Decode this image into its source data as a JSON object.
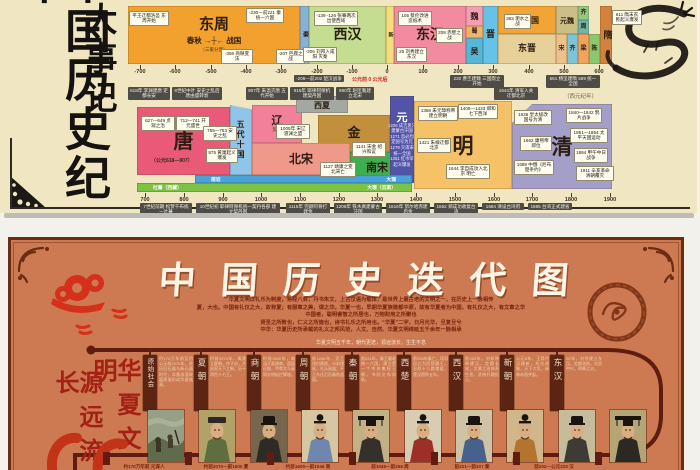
{
  "page": {
    "background": "#f2f1ec"
  },
  "top_poster": {
    "title_vertical": "中国历史纪年",
    "subtitle_vertical": "大事记",
    "era_note": "公元前 0 公元后",
    "calendar_note": "（西元纪年）",
    "row1": {
      "blocks": [
        {
          "name": "dongzhou",
          "label": "东周",
          "sub": "春秋 →┼← 战国",
          "sub2": "（三家分晋）",
          "x": 128,
          "y": 6,
          "w": 172,
          "h": 58,
          "color": "#f2a12e",
          "fs": 15
        },
        {
          "name": "qin",
          "label": "秦",
          "x": 300,
          "y": 6,
          "w": 9,
          "h": 58,
          "color": "#85b3d4",
          "fs": 6,
          "vertical": true
        },
        {
          "name": "xihan",
          "label": "西汉",
          "x": 309,
          "y": 6,
          "w": 77,
          "h": 58,
          "color": "#c4dd90",
          "fs": 14
        },
        {
          "name": "xin",
          "label": "新",
          "x": 386,
          "y": 6,
          "w": 8,
          "h": 58,
          "color": "#f2de7c",
          "fs": 5,
          "vertical": true
        },
        {
          "name": "donghan",
          "label": "东汉",
          "x": 394,
          "y": 6,
          "w": 72,
          "h": 58,
          "color": "#f28ba0",
          "fs": 14
        },
        {
          "name": "wei",
          "label": "魏",
          "x": 466,
          "y": 6,
          "w": 17,
          "h": 20,
          "color": "#f29eb4",
          "fs": 8
        },
        {
          "name": "shu",
          "label": "蜀",
          "x": 466,
          "y": 26,
          "w": 17,
          "h": 12,
          "color": "#f0b468",
          "fs": 6
        },
        {
          "name": "wu",
          "label": "吴",
          "x": 466,
          "y": 38,
          "w": 17,
          "h": 26,
          "color": "#56b6d8",
          "fs": 8
        },
        {
          "name": "jin",
          "label": "晋",
          "x": 483,
          "y": 6,
          "w": 15,
          "h": 58,
          "color": "#66c2e6",
          "fs": 9
        },
        {
          "name": "shiliuguo",
          "label": "十六国",
          "x": 498,
          "y": 6,
          "w": 58,
          "h": 28,
          "color": "#f2a434",
          "fs": 8
        },
        {
          "name": "dongjin",
          "label": "东晋",
          "x": 498,
          "y": 34,
          "w": 58,
          "h": 30,
          "color": "#e7d198",
          "fs": 9
        },
        {
          "name": "yuanwei",
          "label": "元魏",
          "x": 556,
          "y": 6,
          "w": 22,
          "h": 28,
          "color": "#ccbf86",
          "fs": 7
        },
        {
          "name": "qi-north",
          "label": "齐",
          "x": 578,
          "y": 6,
          "w": 11,
          "h": 14,
          "color": "#93c87e",
          "fs": 6
        },
        {
          "name": "zhou-north",
          "label": "周",
          "x": 578,
          "y": 20,
          "w": 11,
          "h": 14,
          "color": "#6cb9a9",
          "fs": 6
        },
        {
          "name": "song-south",
          "label": "宋",
          "x": 556,
          "y": 34,
          "w": 11,
          "h": 30,
          "color": "#ecc28a",
          "fs": 6
        },
        {
          "name": "qi-south",
          "label": "齐",
          "x": 567,
          "y": 34,
          "w": 11,
          "h": 30,
          "color": "#7cc4d8",
          "fs": 6
        },
        {
          "name": "liang-south",
          "label": "梁",
          "x": 578,
          "y": 34,
          "w": 11,
          "h": 30,
          "color": "#f0a45c",
          "fs": 6
        },
        {
          "name": "chen-south",
          "label": "陈",
          "x": 589,
          "y": 34,
          "w": 11,
          "h": 30,
          "color": "#8cc86e",
          "fs": 6
        },
        {
          "name": "sui",
          "label": "隋",
          "x": 600,
          "y": 6,
          "w": 12,
          "h": 58,
          "color": "#d2823c",
          "fs": 9,
          "vertical": true
        }
      ],
      "ticks": [
        {
          "t": "-700",
          "x": 140
        },
        {
          "t": "-600",
          "x": 175
        },
        {
          "t": "-500",
          "x": 211
        },
        {
          "t": "-400",
          "x": 246
        },
        {
          "t": "-300",
          "x": 281
        },
        {
          "t": "-200",
          "x": 317
        },
        {
          "t": "-100",
          "x": 352
        },
        {
          "t": "0",
          "x": 387
        },
        {
          "t": "100",
          "x": 423
        },
        {
          "t": "200",
          "x": 458
        },
        {
          "t": "300",
          "x": 493
        },
        {
          "t": "400",
          "x": 529
        },
        {
          "t": "500",
          "x": 564
        },
        {
          "t": "600",
          "x": 599
        }
      ],
      "tick_y": 65,
      "chips": [
        {
          "t": "平王迁都洛邑 东周开始",
          "x": 129,
          "y": 11,
          "w": 36
        },
        {
          "t": "-356 商鞅变法",
          "x": 221,
          "y": 49,
          "w": 28
        },
        {
          "t": "-230—前221 秦统一六国",
          "x": 246,
          "y": 8,
          "w": 34
        },
        {
          "t": "-207 巨鹿之战",
          "x": 276,
          "y": 49,
          "w": 25
        },
        {
          "t": "-206 刘邦入咸阳 灭秦",
          "x": 303,
          "y": 47,
          "w": 30
        },
        {
          "t": "-139 -126 张骞两次出使西域",
          "x": 314,
          "y": 11,
          "w": 40
        },
        {
          "t": "25 刘秀建立东汉",
          "x": 396,
          "y": 47,
          "w": 27
        },
        {
          "t": "105 蔡伦改进造纸术",
          "x": 398,
          "y": 11,
          "w": 30
        },
        {
          "t": "208 赤壁之战",
          "x": 436,
          "y": 28,
          "w": 23
        },
        {
          "t": "383 淝水之战",
          "x": 504,
          "y": 14,
          "w": 23
        },
        {
          "t": "611 隋末农民起义爆发",
          "x": 612,
          "y": 10,
          "w": 26
        }
      ],
      "dark_chips": [
        {
          "t": "-206—前202 楚汉战争",
          "x": 294,
          "y": 75,
          "w": 46
        },
        {
          "t": "220 曹丕建魏 三国鼎立开始",
          "x": 450,
          "y": 75,
          "w": 50
        },
        {
          "t": "581 杨坚建隋 589 统一全国",
          "x": 546,
          "y": 75,
          "w": 50
        }
      ]
    },
    "row2": {
      "top_chips": [
        {
          "t": "618年 李渊建唐 定都长安",
          "x": 128,
          "w": 38
        },
        {
          "t": "8世纪中叶 安史之乱后 唐由盛转衰",
          "x": 172,
          "w": 46
        },
        {
          "t": "907年 朱温灭唐 五代开始",
          "x": 246,
          "w": 38
        },
        {
          "t": "916年 耶律阿保机建契丹国",
          "x": 290,
          "w": 40
        },
        {
          "t": "960年 赵匡胤建立北宋",
          "x": 336,
          "w": 34
        },
        {
          "t": "1644年 清军入关 迁都北京",
          "x": 494,
          "w": 40
        }
      ],
      "blocks": [
        {
          "name": "tang",
          "label": "唐",
          "x": 137,
          "y": 107,
          "w": 93,
          "h": 68,
          "color": "#e85a78",
          "fs": 20
        },
        {
          "name": "wudai-shiguo",
          "label": "五代十国",
          "x": 230,
          "y": 105,
          "w": 22,
          "h": 70,
          "color": "#90c4e8",
          "fs": 8,
          "vertical": true,
          "clip": "polygon(0 0,100% 6%,100% 100%,0 100%)"
        },
        {
          "name": "liao",
          "label": "辽",
          "sub2": "契丹",
          "x": 252,
          "y": 105,
          "w": 50,
          "h": 38,
          "color": "#f2809a",
          "fs": 11
        },
        {
          "name": "xixia",
          "label": "西夏",
          "x": 296,
          "y": 96,
          "w": 52,
          "h": 17,
          "color": "#a3a8a2",
          "fs": 8
        },
        {
          "name": "jin-dynasty",
          "label": "金",
          "x": 318,
          "y": 115,
          "w": 72,
          "h": 37,
          "color": "#c2903c",
          "fs": 13
        },
        {
          "name": "beisong",
          "label": "北宋",
          "x": 252,
          "y": 143,
          "w": 98,
          "h": 32,
          "color": "#ef998a",
          "fs": 12
        },
        {
          "name": "nansong",
          "label": "南宋",
          "x": 350,
          "y": 152,
          "w": 54,
          "h": 31,
          "color": "#3fae4e",
          "fs": 11
        },
        {
          "name": "yuan",
          "label": "元",
          "x": 390,
          "y": 96,
          "w": 24,
          "h": 87,
          "color": "#5254a6",
          "fs": 11,
          "tc": "#ffffff",
          "lines": [
            "1206 成吉思汗",
            "建蒙古汗国",
            "1271 忽必烈",
            "定国号为元",
            "1279 灭南宋",
            "统一全国",
            "1351 红巾军",
            "起义爆发"
          ]
        },
        {
          "name": "ming",
          "label": "明",
          "x": 414,
          "y": 101,
          "w": 98,
          "h": 88,
          "color": "#f5c268",
          "fs": 21
        },
        {
          "name": "qing",
          "label": "清",
          "x": 512,
          "y": 104,
          "w": 100,
          "h": 85,
          "color": "#a39fc9",
          "fs": 21,
          "clip": "polygon(0 22%,20% 0,100% 0,100% 100%,0 100%)"
        }
      ],
      "strips": [
        {
          "name": "nanzhao-dali-strip",
          "l1": "南诏",
          "l2": "大理",
          "x": 195,
          "y": 175,
          "w": 217,
          "h": 8,
          "color": "#49a2d8"
        },
        {
          "name": "tubo-strip",
          "l1": "吐蕃（西藏）",
          "l2": "大理（云南）",
          "x": 137,
          "y": 183,
          "w": 275,
          "h": 9,
          "color": "#7cc244"
        }
      ],
      "ticks": [
        {
          "t": "700",
          "x": 145
        },
        {
          "t": "800",
          "x": 184
        },
        {
          "t": "900",
          "x": 223
        },
        {
          "t": "1000",
          "x": 261
        },
        {
          "t": "1100",
          "x": 300
        },
        {
          "t": "1200",
          "x": 339
        },
        {
          "t": "1300",
          "x": 377
        },
        {
          "t": "1400",
          "x": 416
        },
        {
          "t": "1500",
          "x": 455
        },
        {
          "t": "1600",
          "x": 494
        },
        {
          "t": "1700",
          "x": 532
        },
        {
          "t": "1800",
          "x": 571
        },
        {
          "t": "1900",
          "x": 610
        }
      ],
      "tick_y": 193,
      "chips": [
        {
          "t": "627—649 贞观之治",
          "x": 141,
          "y": 116,
          "w": 30
        },
        {
          "t": "712—741 开元盛世",
          "x": 176,
          "y": 116,
          "w": 30
        },
        {
          "t": "755—763 安史之乱",
          "x": 203,
          "y": 126,
          "w": 30
        },
        {
          "t": "875 黄巢起义爆发",
          "x": 206,
          "y": 148,
          "w": 28
        },
        {
          "t": "（公元618—907）",
          "x": 150,
          "y": 158,
          "w": 40,
          "plain": true
        },
        {
          "t": "1005年 宋辽 澶渊之盟",
          "x": 276,
          "y": 124,
          "w": 30
        },
        {
          "t": "1141 宋金 绍兴和议",
          "x": 352,
          "y": 142,
          "w": 30
        },
        {
          "t": "1127 靖康之变 北宋亡",
          "x": 320,
          "y": 162,
          "w": 32
        },
        {
          "t": "1368 朱元璋称帝 建立明朝",
          "x": 418,
          "y": 106,
          "w": 36
        },
        {
          "t": "1405—1433 郑和七下西洋",
          "x": 458,
          "y": 104,
          "w": 36
        },
        {
          "t": "1421 朱棣迁都北京",
          "x": 417,
          "y": 138,
          "w": 30
        },
        {
          "t": "1644 李自成攻入北京 明亡",
          "x": 446,
          "y": 164,
          "w": 40
        },
        {
          "t": "1636 皇太极改国号为清",
          "x": 514,
          "y": 110,
          "w": 34
        },
        {
          "t": "1662 康熙帝即位",
          "x": 520,
          "y": 136,
          "w": 28
        },
        {
          "t": "1689 中俄《尼布楚条约》",
          "x": 514,
          "y": 160,
          "w": 36
        },
        {
          "t": "1840—1842 鸦片战争",
          "x": 566,
          "y": 108,
          "w": 32
        },
        {
          "t": "1851—1864 太平天国运动",
          "x": 570,
          "y": 128,
          "w": 34
        },
        {
          "t": "1894 甲午中日战争",
          "x": 574,
          "y": 148,
          "w": 30
        },
        {
          "t": "1911 辛亥革命 清朝覆灭",
          "x": 576,
          "y": 166,
          "w": 34
        }
      ],
      "dark_chips": [
        {
          "t": "7世纪前期 松赞干布统一吐蕃",
          "x": 140,
          "y": 203,
          "w": 48
        },
        {
          "t": "10世纪初 耶律阿保机统一契丹各部 建立契丹国",
          "x": 196,
          "y": 203,
          "w": 80
        },
        {
          "t": "1115年 完颜阿骨打建金",
          "x": 286,
          "y": 203,
          "w": 40
        },
        {
          "t": "1206年 铁木真建蒙古汗国",
          "x": 334,
          "y": 203,
          "w": 44
        },
        {
          "t": "1616年 努尔哈赤建后金",
          "x": 386,
          "y": 203,
          "w": 40
        },
        {
          "t": "1662 郑成功收复台湾",
          "x": 434,
          "y": 203,
          "w": 40
        },
        {
          "t": "1684 清设台湾府",
          "x": 482,
          "y": 203,
          "w": 38
        },
        {
          "t": "1885 台湾正式建省",
          "x": 528,
          "y": 203,
          "w": 40
        }
      ]
    }
  },
  "bottom_poster": {
    "title": "中国历史迭代图",
    "slogan_col1": "华夏文明",
    "slogan_col2": "源远流长",
    "intro_lines": [
      "华夏文明以礼乐为制度，易经八卦，丹书朱文，上古汉语为载体，是世界上最古老的文明之一，在历史上一脉相传",
      "夏，大也。中国有礼仪之大，故称夏；有服章之美，谓之华。华夏一也，早期华夏族建都中原，故有华夏者为中国，有礼仪之大，有文章之华",
      "中国者，聪明睿智之所居也，万物财用之所聚也",
      "贤圣之所教也，仁义之所施也，诗书礼乐之所用也。“华夏”二字，日月光华，旦复旦兮",
      "中华：华夏历史所承载的礼义之邦风范，人文、自然、华夏文明绵延五千余年一脉相承"
    ],
    "timeline_caption": "华夏文明五千年，朝代更迭，源远流长，生生不息",
    "banners": [
      {
        "label": "原始社会",
        "x": 147,
        "small": true
      },
      {
        "label": "夏朝",
        "x": 198
      },
      {
        "label": "商朝",
        "x": 251
      },
      {
        "label": "周朝",
        "x": 300
      },
      {
        "label": "秦朝",
        "x": 349
      },
      {
        "label": "西楚",
        "x": 401
      },
      {
        "label": "西汉",
        "x": 453
      },
      {
        "label": "新朝",
        "x": 504
      },
      {
        "label": "东汉",
        "x": 554
      }
    ],
    "timeline_notes": [
      {
        "t": "约170万年前至约公元前2070年，经历旧石器与新石器时代，炎黄部落联盟逐渐形成华夏族源。",
        "x": 156,
        "w": 34
      },
      {
        "t": "约前2070年，禹建立夏朝，传子启，开启家天下之制，历十四世十七王。",
        "x": 207,
        "w": 36
      },
      {
        "t": "约前1600年，商汤灭夏建商，盘庚迁殷，甲骨文与青铜文明灿烂辉煌。",
        "x": 260,
        "w": 32
      },
      {
        "t": "前1046年，武王伐纣建周，分封诸侯，礼乐昌盛；平王东迁后历春秋战国。",
        "x": 309,
        "w": 32
      },
      {
        "t": "前221年，秦王嬴政统一六国，建立第一个中央集权王朝，书同文车同轨。",
        "x": 358,
        "w": 35
      },
      {
        "t": "前206年秦亡，项羽自立为西楚霸王，分封十八路诸侯，楚汉相争五年。",
        "x": 410,
        "w": 35
      },
      {
        "t": "前202年，刘邦称帝建汉，定都长安，文景之治休养生息，武帝开疆拓土。",
        "x": 462,
        "w": 34
      },
      {
        "t": "公元8年，王莽代汉建新，托古改制，天下大乱，绿林赤眉并起。",
        "x": 513,
        "w": 33
      },
      {
        "t": "25年，刘秀建立东汉，定都洛阳，光武中兴，明章之治。",
        "x": 563,
        "w": 36
      }
    ],
    "portraits": [
      {
        "name": "primitive-society",
        "type": "scene",
        "bg": "#96a086",
        "robe": "#55604a",
        "x": 145
      },
      {
        "name": "xia-dynasty-yu",
        "type": "flat",
        "bg": "#b3a268",
        "robe": "#5f6e3f",
        "x": 196
      },
      {
        "name": "shang-dynasty-tang",
        "type": "crown",
        "bg": "#77664e",
        "robe": "#2e2a26",
        "x": 248
      },
      {
        "name": "zhou-king-wen",
        "type": "bun",
        "bg": "#d6c6a2",
        "robe": "#6f86ae",
        "x": 299
      },
      {
        "name": "qin-shihuang",
        "type": "mian",
        "bg": "#c2b184",
        "robe": "#35302b",
        "x": 350
      },
      {
        "name": "xichu-bawang-xiangyu",
        "type": "bun",
        "bg": "#d8cdb2",
        "robe": "#9e2f26",
        "x": 402
      },
      {
        "name": "han-gaozu-liubang",
        "type": "crown",
        "bg": "#cec3a4",
        "robe": "#47608c",
        "x": 453
      },
      {
        "name": "han-wudi",
        "type": "bun",
        "bg": "#d0b689",
        "robe": "#b3742e",
        "x": 504
      },
      {
        "name": "xin-dynasty-wangmang",
        "type": "crown",
        "bg": "#c6bc9c",
        "robe": "#3e3a34",
        "x": 556
      },
      {
        "name": "donghan-guangwudi",
        "type": "mian",
        "bg": "#b5a576",
        "robe": "#2c2824",
        "x": 607
      }
    ],
    "node_xs": [
      100,
      182,
      264,
      346,
      428,
      510,
      592
    ],
    "bottom_labels": [
      {
        "t": "约170万年前 元谋人",
        "x": 141
      },
      {
        "t": "约前2070—前1600 夏",
        "x": 223
      },
      {
        "t": "约前1600—前1046 商",
        "x": 305
      },
      {
        "t": "前1046—前256 周",
        "x": 387
      },
      {
        "t": "前221—前207 秦",
        "x": 469
      },
      {
        "t": "前202—公元220 汉",
        "x": 551
      }
    ]
  }
}
